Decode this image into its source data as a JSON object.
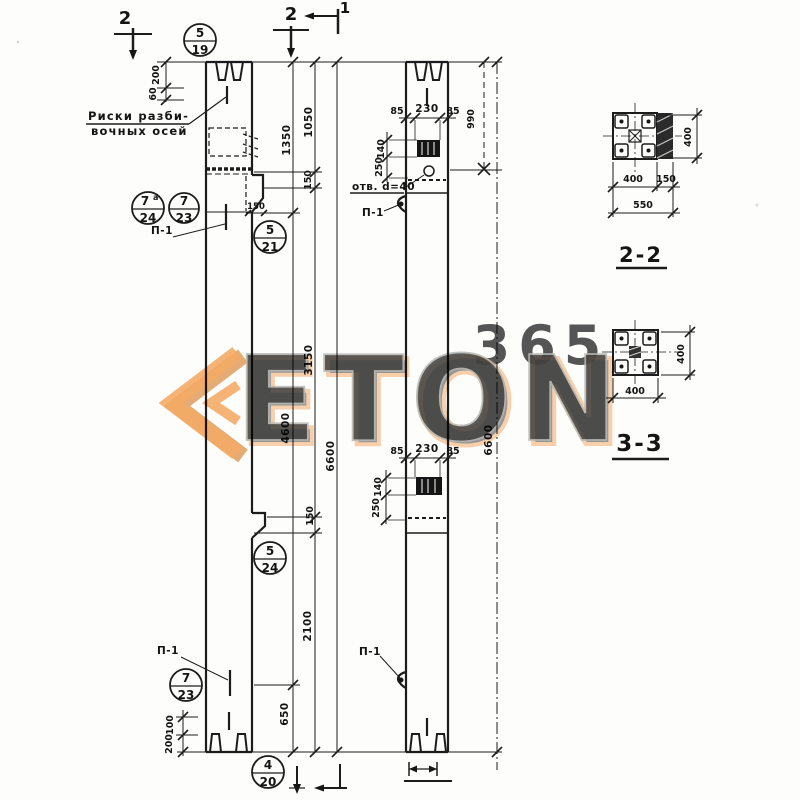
{
  "watermark": {
    "logo_text": "ETON",
    "number": "365",
    "accent_color": "#ef9440",
    "letter_color": "#e8e8e4"
  },
  "section_marks": {
    "cut2_left": "2",
    "cut2_mid": "2",
    "cut1": "1"
  },
  "callouts": [
    {
      "top": "5",
      "bottom": "19"
    },
    {
      "top": "7",
      "sup": "а",
      "bottom": "24"
    },
    {
      "top": "7",
      "bottom": "23"
    },
    {
      "top": "5",
      "bottom": "21"
    },
    {
      "top": "5",
      "bottom": "24"
    },
    {
      "top": "7",
      "bottom": "23"
    },
    {
      "top": "4",
      "bottom": "20"
    }
  ],
  "notes": {
    "axis_note_line1": "Риски разби-",
    "axis_note_line2": "вочных осей",
    "hole_note": "отв. d=40",
    "hook_label": "П-1"
  },
  "dimensions": {
    "top_left": [
      "200",
      "60"
    ],
    "line_a": [
      "1350",
      "4600",
      "650"
    ],
    "line_b": [
      "1050",
      "150",
      "3150",
      "150",
      "2100"
    ],
    "total_left": "6600",
    "corbel_width": "150",
    "mid_width_top": [
      "85",
      "230",
      "85"
    ],
    "mid_plate_top": [
      "140",
      "250"
    ],
    "mid_width_low": [
      "85",
      "230",
      "85"
    ],
    "mid_plate_low": [
      "140",
      "250"
    ],
    "top_to_hole": "990",
    "total_mid": "6600",
    "bottom_left": [
      "100",
      "200"
    ]
  },
  "sections": {
    "s22": {
      "title": "2-2",
      "height": "400",
      "width": "400",
      "strip": "150",
      "total": "550"
    },
    "s33": {
      "title": "3-3",
      "height": "400",
      "width": "400"
    }
  }
}
